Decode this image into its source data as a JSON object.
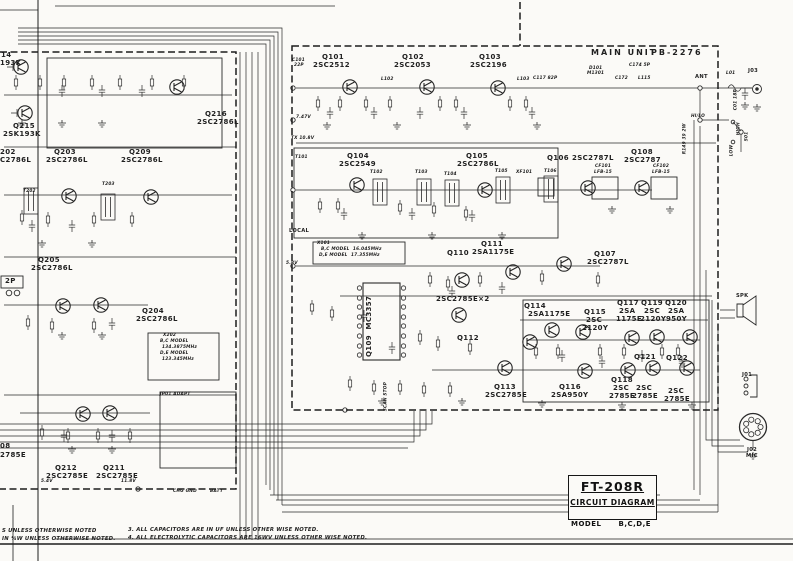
{
  "title_block": {
    "name": "FT-208R",
    "title": "CIRCUIT DIAGRAM",
    "model_label": "MODEL",
    "model_value": "B,C,D,E"
  },
  "notes": {
    "l1": "S UNLESS OTHERWISE NOTED",
    "l2": "IN ¼W UNLESS OTHERWISE NOTED.",
    "r1": "3. ALL CAPACITORS ARE IN UF UNLESS OTHER WISE NOTED.",
    "r2": "4. ALL ELECTROLYTIC CAPACITORS ARE 16WV UNLESS OTHER WISE NOTED."
  },
  "ink_color": "#1f1f1f",
  "paper_color": "#fbfaf7",
  "labels": [
    {
      "t": "MAIN UNIT",
      "x": 591,
      "y": 49,
      "c": "d"
    },
    {
      "t": "PB-2276",
      "x": 651,
      "y": 49,
      "c": "d"
    },
    {
      "t": "Q101",
      "x": 322,
      "y": 54,
      "c": "b"
    },
    {
      "t": "2SC2512",
      "x": 313,
      "y": 62,
      "c": "b"
    },
    {
      "t": "Q102",
      "x": 402,
      "y": 54,
      "c": "b"
    },
    {
      "t": "2SC2053",
      "x": 394,
      "y": 62,
      "c": "b"
    },
    {
      "t": "Q103",
      "x": 479,
      "y": 54,
      "c": "b"
    },
    {
      "t": "2SC2196",
      "x": 470,
      "y": 62,
      "c": "b"
    },
    {
      "t": "Q104",
      "x": 347,
      "y": 153,
      "c": "b"
    },
    {
      "t": "2SC2549",
      "x": 339,
      "y": 161,
      "c": "b"
    },
    {
      "t": "Q105",
      "x": 466,
      "y": 153,
      "c": "b"
    },
    {
      "t": "2SC2786L",
      "x": 457,
      "y": 161,
      "c": "b"
    },
    {
      "t": "Q106",
      "x": 547,
      "y": 155,
      "c": "b"
    },
    {
      "t": "2SC2787L",
      "x": 572,
      "y": 155,
      "c": "b"
    },
    {
      "t": "Q108",
      "x": 631,
      "y": 149,
      "c": "b"
    },
    {
      "t": "2SC2787",
      "x": 624,
      "y": 157,
      "c": "b"
    },
    {
      "t": "Q107",
      "x": 594,
      "y": 251,
      "c": "b"
    },
    {
      "t": "2SC2787L",
      "x": 587,
      "y": 259,
      "c": "b"
    },
    {
      "t": "Q110",
      "x": 447,
      "y": 250,
      "c": "b"
    },
    {
      "t": "Q111",
      "x": 481,
      "y": 241,
      "c": "b"
    },
    {
      "t": "2SA1175E",
      "x": 472,
      "y": 249,
      "c": "b"
    },
    {
      "t": "2SC2785E×2",
      "x": 436,
      "y": 296,
      "c": "b"
    },
    {
      "t": "Q112",
      "x": 457,
      "y": 335,
      "c": "b"
    },
    {
      "t": "Q109  MC3357",
      "x": 373,
      "y": 350,
      "c": "b",
      "r": -90
    },
    {
      "t": "Q113",
      "x": 494,
      "y": 384,
      "c": "b"
    },
    {
      "t": "2SC2785E",
      "x": 485,
      "y": 392,
      "c": "b"
    },
    {
      "t": "Q116",
      "x": 559,
      "y": 384,
      "c": "b"
    },
    {
      "t": "2SA950Y",
      "x": 551,
      "y": 392,
      "c": "b"
    },
    {
      "t": "Q114",
      "x": 524,
      "y": 303,
      "c": "b"
    },
    {
      "t": "2SA1175E",
      "x": 528,
      "y": 311,
      "c": "b"
    },
    {
      "t": "Q115",
      "x": 584,
      "y": 309,
      "c": "b"
    },
    {
      "t": "2SC",
      "x": 586,
      "y": 317,
      "c": "b"
    },
    {
      "t": "2120Y",
      "x": 582,
      "y": 325,
      "c": "b"
    },
    {
      "t": "Q117",
      "x": 617,
      "y": 300,
      "c": "b"
    },
    {
      "t": "2SA",
      "x": 619,
      "y": 308,
      "c": "b"
    },
    {
      "t": "1175E",
      "x": 616,
      "y": 316,
      "c": "b"
    },
    {
      "t": "Q119",
      "x": 641,
      "y": 300,
      "c": "b"
    },
    {
      "t": "2SC",
      "x": 644,
      "y": 308,
      "c": "b"
    },
    {
      "t": "2120Y",
      "x": 640,
      "y": 316,
      "c": "b"
    },
    {
      "t": "Q120",
      "x": 665,
      "y": 300,
      "c": "b"
    },
    {
      "t": "2SA",
      "x": 668,
      "y": 308,
      "c": "b"
    },
    {
      "t": "950Y",
      "x": 666,
      "y": 316,
      "c": "b"
    },
    {
      "t": "Q121",
      "x": 634,
      "y": 354,
      "c": "b"
    },
    {
      "t": "Q118",
      "x": 611,
      "y": 377,
      "c": "b"
    },
    {
      "t": "2SC",
      "x": 613,
      "y": 385,
      "c": "b"
    },
    {
      "t": "2785E",
      "x": 609,
      "y": 393,
      "c": "b"
    },
    {
      "t": "2SC",
      "x": 636,
      "y": 385,
      "c": "b"
    },
    {
      "t": "2785E",
      "x": 632,
      "y": 393,
      "c": "b"
    },
    {
      "t": "Q122",
      "x": 666,
      "y": 355,
      "c": "b"
    },
    {
      "t": "2SC",
      "x": 668,
      "y": 388,
      "c": "b"
    },
    {
      "t": "2785E",
      "x": 664,
      "y": 396,
      "c": "b"
    },
    {
      "t": "Q215",
      "x": 13,
      "y": 123,
      "c": "b"
    },
    {
      "t": "2SK193K",
      "x": 3,
      "y": 131,
      "c": "b"
    },
    {
      "t": "14",
      "x": 1,
      "y": 52,
      "c": "b"
    },
    {
      "t": "193K",
      "x": 0,
      "y": 60,
      "c": "b"
    },
    {
      "t": "202",
      "x": 0,
      "y": 149,
      "c": "b"
    },
    {
      "t": "C2786L",
      "x": 0,
      "y": 157,
      "c": "b"
    },
    {
      "t": "Q203",
      "x": 54,
      "y": 149,
      "c": "b"
    },
    {
      "t": "2SC2786L",
      "x": 46,
      "y": 157,
      "c": "b"
    },
    {
      "t": "Q209",
      "x": 129,
      "y": 149,
      "c": "b"
    },
    {
      "t": "2SC2786L",
      "x": 121,
      "y": 157,
      "c": "b"
    },
    {
      "t": "Q216",
      "x": 205,
      "y": 111,
      "c": "b"
    },
    {
      "t": "2SC2786L",
      "x": 197,
      "y": 119,
      "c": "b"
    },
    {
      "t": "Q205",
      "x": 38,
      "y": 257,
      "c": "b"
    },
    {
      "t": "2SC2786L",
      "x": 31,
      "y": 265,
      "c": "b"
    },
    {
      "t": "Q204",
      "x": 142,
      "y": 308,
      "c": "b"
    },
    {
      "t": "2SC2786L",
      "x": 136,
      "y": 316,
      "c": "b"
    },
    {
      "t": "Q212",
      "x": 55,
      "y": 465,
      "c": "b"
    },
    {
      "t": "2SC2785E",
      "x": 46,
      "y": 473,
      "c": "b"
    },
    {
      "t": "Q211",
      "x": 103,
      "y": 465,
      "c": "b"
    },
    {
      "t": "2SC2785E",
      "x": 96,
      "y": 473,
      "c": "b"
    },
    {
      "t": "08",
      "x": 0,
      "y": 443,
      "c": "b"
    },
    {
      "t": "2785E",
      "x": 0,
      "y": 452,
      "c": "b"
    },
    {
      "t": "2P",
      "x": 5,
      "y": 278,
      "c": "b"
    },
    {
      "t": "ANT",
      "x": 695,
      "y": 75,
      "c": "s"
    },
    {
      "t": "L01",
      "x": 726,
      "y": 72,
      "c": "x"
    },
    {
      "t": "J03",
      "x": 748,
      "y": 69,
      "c": "s"
    },
    {
      "t": "C01 18P",
      "x": 739,
      "y": 106,
      "c": "x",
      "r": -90
    },
    {
      "t": "HI/LO",
      "x": 691,
      "y": 115,
      "c": "x"
    },
    {
      "t": "HIGH",
      "x": 742,
      "y": 131,
      "c": "x",
      "r": -90
    },
    {
      "t": "S01",
      "x": 750,
      "y": 137,
      "c": "x",
      "r": -90
    },
    {
      "t": "LOW",
      "x": 735,
      "y": 152,
      "c": "x",
      "r": -90
    },
    {
      "t": "R149 39 2W",
      "x": 688,
      "y": 150,
      "c": "x",
      "r": -90
    },
    {
      "t": "SPK",
      "x": 736,
      "y": 294,
      "c": "s"
    },
    {
      "t": "J01",
      "x": 742,
      "y": 373,
      "c": "s"
    },
    {
      "t": "J02",
      "x": 747,
      "y": 448,
      "c": "s"
    },
    {
      "t": "MIC",
      "x": 746,
      "y": 454,
      "c": "s"
    },
    {
      "t": "X101",
      "x": 317,
      "y": 242,
      "c": "x"
    },
    {
      "t": "B,C MODEL  16.045MHz",
      "x": 321,
      "y": 248,
      "c": "x"
    },
    {
      "t": "D,E MODEL  17.355MHz",
      "x": 319,
      "y": 254,
      "c": "x"
    },
    {
      "t": "X202",
      "x": 163,
      "y": 334,
      "c": "x"
    },
    {
      "t": "B,C MODEL",
      "x": 160,
      "y": 340,
      "c": "x"
    },
    {
      "t": "134.3875MHz",
      "x": 162,
      "y": 346,
      "c": "x"
    },
    {
      "t": "D,E MODEL",
      "x": 160,
      "y": 352,
      "c": "x"
    },
    {
      "t": "123.345MHz",
      "x": 162,
      "y": 358,
      "c": "x"
    },
    {
      "t": "5.8V",
      "x": 286,
      "y": 262,
      "c": "x"
    },
    {
      "t": "7.47V",
      "x": 296,
      "y": 116,
      "c": "x"
    },
    {
      "t": "TX 10.8V",
      "x": 291,
      "y": 137,
      "c": "x"
    },
    {
      "t": "LOCAL",
      "x": 289,
      "y": 229,
      "c": "s"
    },
    {
      "t": "SCAN STOP",
      "x": 389,
      "y": 407,
      "c": "x",
      "r": -90
    },
    {
      "t": "JP01 ADAPT",
      "x": 160,
      "y": 393,
      "c": "x"
    },
    {
      "t": "CHG GND",
      "x": 173,
      "y": 490,
      "c": "x"
    },
    {
      "t": "BATT",
      "x": 210,
      "y": 490,
      "c": "x"
    },
    {
      "t": "5.4V",
      "x": 41,
      "y": 480,
      "c": "x"
    },
    {
      "t": "11.8V",
      "x": 121,
      "y": 480,
      "c": "x"
    },
    {
      "t": "CF101",
      "x": 595,
      "y": 165,
      "c": "x"
    },
    {
      "t": "LFB-15",
      "x": 594,
      "y": 171,
      "c": "x"
    },
    {
      "t": "CF102",
      "x": 653,
      "y": 165,
      "c": "x"
    },
    {
      "t": "LFB-15",
      "x": 652,
      "y": 171,
      "c": "x"
    },
    {
      "t": "XF101",
      "x": 516,
      "y": 171,
      "c": "x"
    },
    {
      "t": "T101",
      "x": 295,
      "y": 156,
      "c": "x"
    },
    {
      "t": "T102",
      "x": 370,
      "y": 171,
      "c": "x"
    },
    {
      "t": "T103",
      "x": 415,
      "y": 171,
      "c": "x"
    },
    {
      "t": "T104",
      "x": 444,
      "y": 173,
      "c": "x"
    },
    {
      "t": "T105",
      "x": 495,
      "y": 170,
      "c": "x"
    },
    {
      "t": "T106",
      "x": 544,
      "y": 170,
      "c": "x"
    },
    {
      "t": "T202",
      "x": 23,
      "y": 190,
      "c": "x"
    },
    {
      "t": "T203",
      "x": 102,
      "y": 183,
      "c": "x"
    },
    {
      "t": "C101",
      "x": 292,
      "y": 59,
      "c": "x"
    },
    {
      "t": "22P",
      "x": 294,
      "y": 64,
      "c": "x"
    },
    {
      "t": "L102",
      "x": 381,
      "y": 78,
      "c": "x"
    },
    {
      "t": "L103",
      "x": 517,
      "y": 78,
      "c": "x"
    },
    {
      "t": "C117 82P",
      "x": 533,
      "y": 77,
      "c": "x"
    },
    {
      "t": "D101",
      "x": 589,
      "y": 67,
      "c": "x"
    },
    {
      "t": "M1301",
      "x": 587,
      "y": 72,
      "c": "x"
    },
    {
      "t": "C174 5P",
      "x": 629,
      "y": 64,
      "c": "x"
    },
    {
      "t": "C172",
      "x": 615,
      "y": 77,
      "c": "x"
    },
    {
      "t": "L115",
      "x": 638,
      "y": 77,
      "c": "x"
    }
  ]
}
